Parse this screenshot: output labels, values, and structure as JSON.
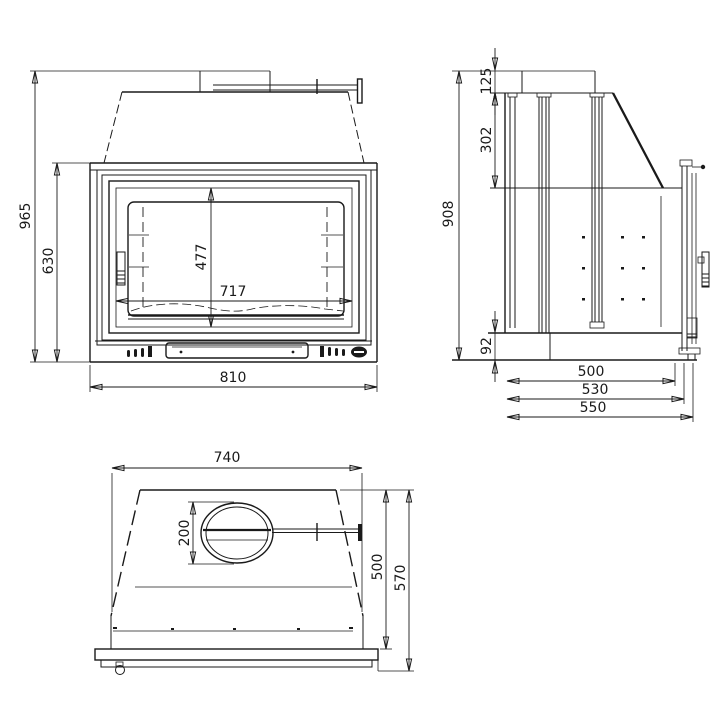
{
  "drawing": {
    "kind": "technical-drawing",
    "subject": "fireplace-insert-three-views",
    "unit_system": "mm",
    "colors": {
      "line": "#1a1a1a",
      "background": "#ffffff"
    },
    "views": {
      "front": {
        "label": "front-view",
        "dimensions": {
          "overall_height": "965",
          "body_height": "630",
          "door_height": "477",
          "door_width": "717",
          "overall_width": "810"
        }
      },
      "side": {
        "label": "side-view",
        "dimensions": {
          "flue_collar_height": "125",
          "hood_top_depth": "302",
          "overall_height": "908",
          "base_height": "92",
          "depth_to_glass": "500",
          "depth_to_door": "530",
          "overall_depth": "550"
        }
      },
      "plan": {
        "label": "top-view",
        "dimensions": {
          "front_width": "740",
          "flue_diameter": "200",
          "depth_to_fascia": "500",
          "overall_depth": "570"
        }
      }
    }
  }
}
